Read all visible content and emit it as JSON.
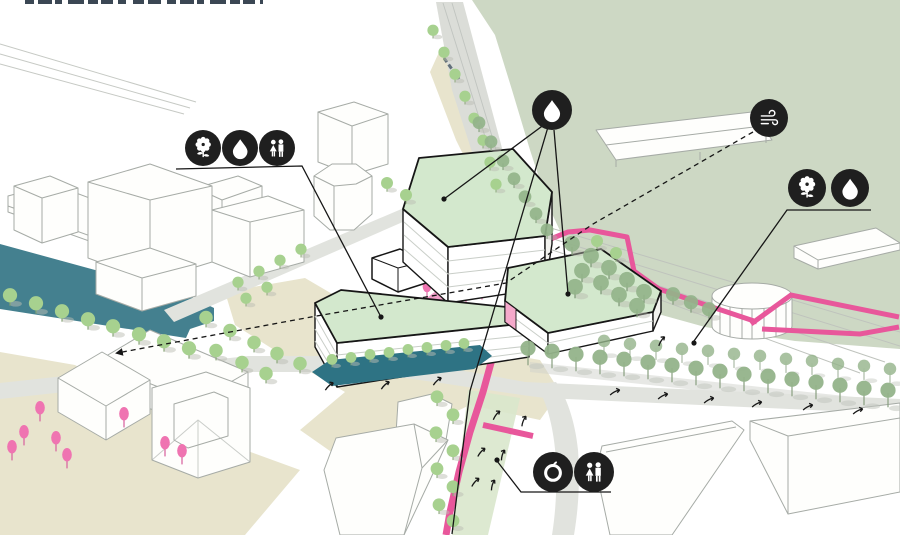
{
  "diagram": {
    "kind": "axonometric-urban-masterplan-concept-diagram",
    "palette": {
      "background": "#ffffff",
      "park_green": "#cdd8c4",
      "ground_beige": "#e8e4cd",
      "canal_teal": "#44808f",
      "road_grey": "#e1e3de",
      "rail_grey": "#dbddd8",
      "roof_mint": "#d3e8cd",
      "tree_green": "#a7d18f",
      "tree_sage": "#93b38a",
      "tree_pink": "#ef74b1",
      "route_pink": "#e8579b",
      "colonnade_teal": "#2e7384",
      "badge_black": "#1f1f1f",
      "outline_black": "#161616",
      "building_outline_grey": "#a6aba6"
    },
    "badge_groups": [
      {
        "id": "left-trio",
        "icons": [
          "flower-gear",
          "water-drop",
          "people-pair"
        ]
      },
      {
        "id": "center-water",
        "icons": [
          "water-drop"
        ]
      },
      {
        "id": "wind",
        "icons": [
          "wind-swirl"
        ]
      },
      {
        "id": "right-pair",
        "icons": [
          "flower-gear",
          "water-drop"
        ]
      },
      {
        "id": "bottom-pair",
        "icons": [
          "apple",
          "people-pair"
        ]
      }
    ]
  }
}
